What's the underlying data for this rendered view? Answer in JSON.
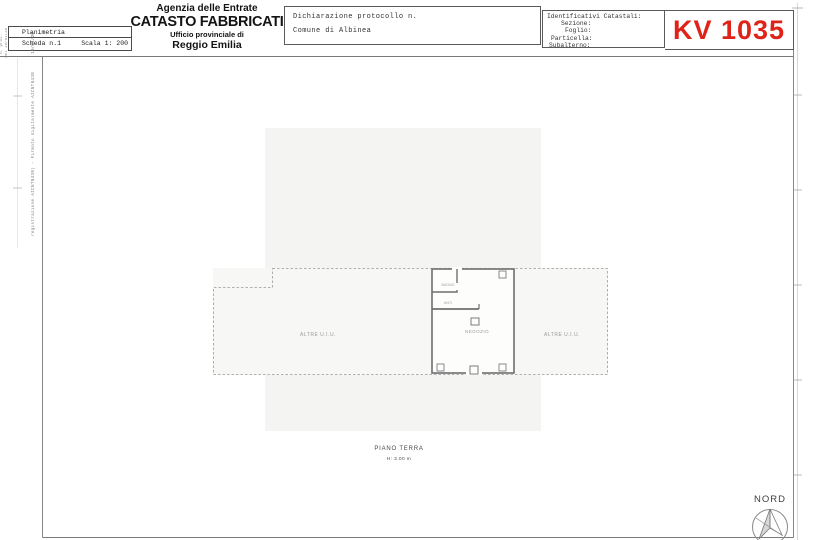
{
  "header": {
    "info_box": {
      "row1": "Planimetria",
      "sheet": "Scheda n.1",
      "scale": "Scala 1: 200"
    },
    "agency": {
      "line1": "Agenzia delle Entrate",
      "line2": "CATASTO FABBRICATI",
      "line3": "Ufficio provinciale di",
      "line4": "Reggio Emilia"
    },
    "declaration": {
      "line1": "Dichiarazione protocollo n.",
      "line2": "Comune di Albinea"
    },
    "cadastral": {
      "title": "Identificativi Catastali:",
      "field1": "Sezione:",
      "field2": "Foglio:",
      "field3": "Particella:",
      "field4": "Subalterno:"
    },
    "sheet_code": "KV 1035"
  },
  "margins": {
    "micro_note_1": "n. prot.",
    "micro_note_2": "del 10/01/20",
    "date_note": "10/01/20",
    "signature_note": "registrazione AICNTN43B) - Firmato digitalmente AICNTN43B"
  },
  "plan": {
    "room_left": "ALTRE U.I.U.",
    "room_center": "NEGOZIO",
    "room_right": "ALTRE U.I.U.",
    "room_bath": "BAGNO",
    "room_anti": "ANTI",
    "caption_title": "PIANO TERRA",
    "caption_height": "H: 3.00 m"
  },
  "compass": {
    "label": "NORD"
  },
  "colors": {
    "sheet_code_red": "#e02318",
    "border_dark": "#555555",
    "plan_line_gray": "#9a9a9a",
    "scan_shading": "#f4f4f2"
  }
}
